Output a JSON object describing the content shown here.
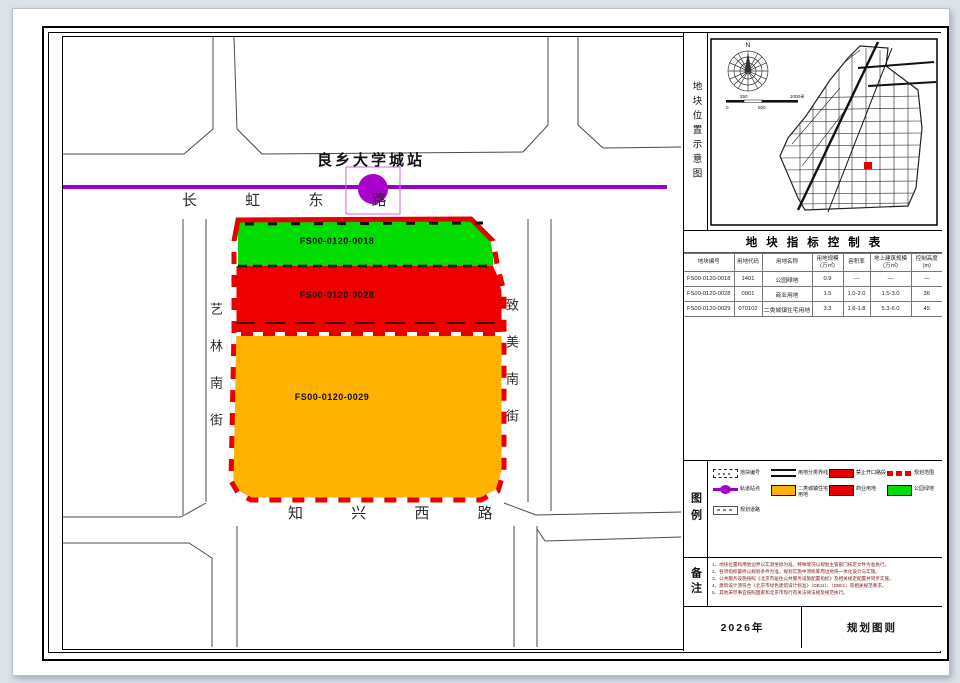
{
  "map": {
    "station": {
      "label": "良乡大学城站"
    },
    "roads": {
      "north": "长 虹 东 路",
      "south": "知 兴 西 路",
      "west": "艺林南街",
      "east": "致美南街"
    },
    "parcels": [
      {
        "id": "FS00-0120-0018",
        "name": "公园绿地",
        "color": "#00dc00"
      },
      {
        "id": "FS00-0120-0028",
        "name": "商业用地",
        "color": "#ee0000"
      },
      {
        "id": "FS00-0120-0029",
        "name": "二类城镇住宅用地",
        "color": "#ffb300"
      }
    ],
    "colors": {
      "metro_line": "#9900cc",
      "planning_boundary": "#e60000"
    }
  },
  "sidebar": {
    "location": {
      "section_label": "地块位置示意图",
      "compass_north": "N",
      "scale_labels": [
        "0",
        "250",
        "500",
        "1000米"
      ]
    },
    "table": {
      "title": "地块指标控制表",
      "headers": [
        "地块编号",
        "用地代码",
        "用地名称",
        "用地规模(万㎡)",
        "容积率",
        "地上建筑规模(万㎡)",
        "控制高度(m)"
      ],
      "rows": [
        [
          "FS00-0120-0018",
          "1401",
          "公园绿地",
          "0.9",
          "—",
          "—",
          "—"
        ],
        [
          "FS00-0120-0028",
          "0901",
          "商业用地",
          "1.5",
          "1.0-2.0",
          "1.5-3.0",
          "36"
        ],
        [
          "FS00-0120-0029",
          "070102",
          "二类城镇住宅用地",
          "3.3",
          "1.6-1.8",
          "5.3-6.0",
          "45"
        ]
      ]
    },
    "legend": {
      "section_label": "图例",
      "items": [
        {
          "label": "地块编号"
        },
        {
          "label": "用地分类界线"
        },
        {
          "label": "禁止开口路段"
        },
        {
          "label": "规划范围"
        },
        {
          "label": "轨道站点"
        },
        {
          "label": "二类城镇住宅用地"
        },
        {
          "label": "商业用地"
        },
        {
          "label": "公园绿地"
        },
        {
          "label": "规划道路"
        }
      ]
    },
    "notes": {
      "section_label": "备注",
      "lines": [
        "1、地块位置和用地边界以实测坐标为准，特殊情况以规划主管部门核定文件为准执行。",
        "2、各项指标最终以规划条件为准，规划实施中须统筹周边地块一体化设计与实施。",
        "3、公共服务设施按照《北京市居住公共服务设施配置指标》及相关规定配置并同步实施。",
        "4、建筑设计须符合《北京市绿色建筑设计标准》（DB11）、（DB01）等相关规范要求。",
        "5、其他未尽事宜按照国家和北京市现行有关法律法规及规范执行。"
      ]
    },
    "footer": {
      "year": "2026年",
      "sheet": "规划图则"
    }
  }
}
